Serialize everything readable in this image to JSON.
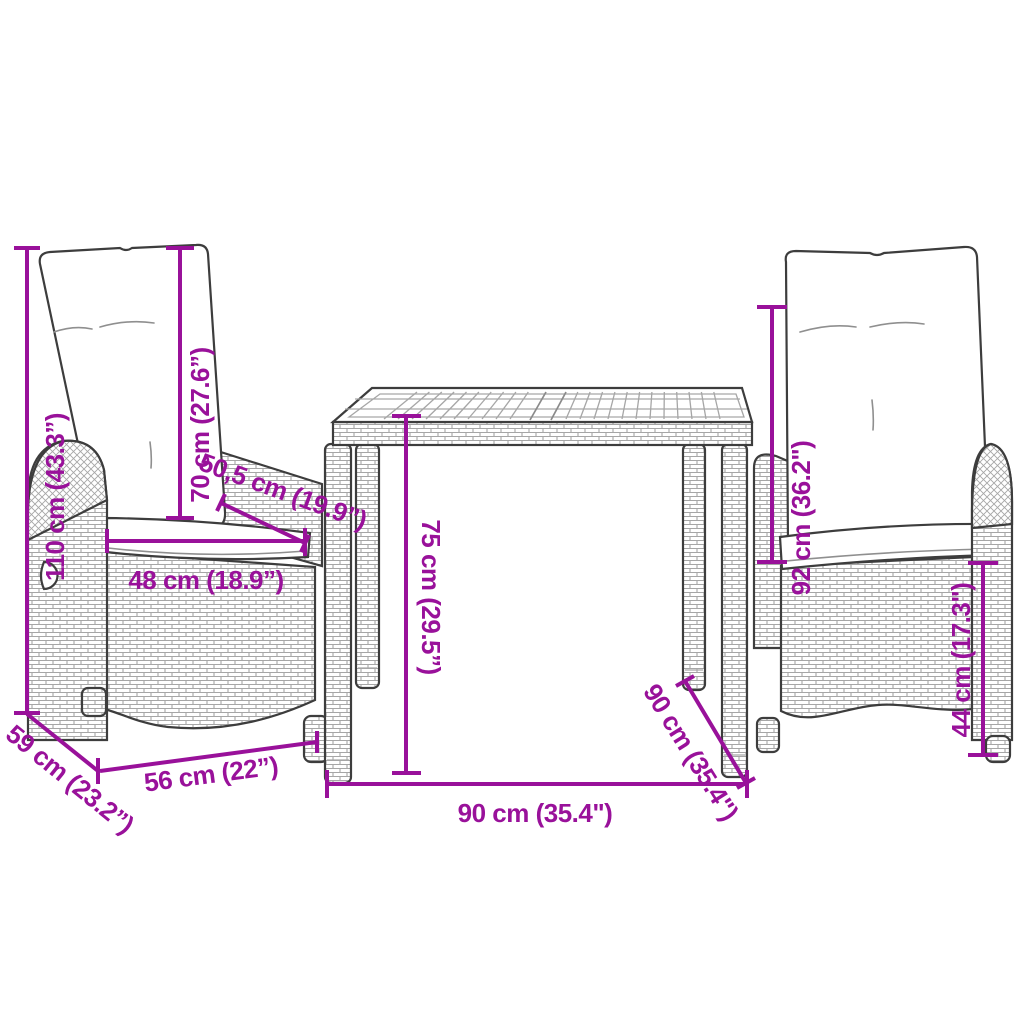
{
  "colors": {
    "accent": "#99119A",
    "outline": "#3D3D3D",
    "weave": "#A6A6A6",
    "background": "#FFFFFF"
  },
  "dimensions": {
    "chair_total_height": "110 cm (43.3”)",
    "chair_back_height": "70 cm (27.6”)",
    "chair_seat_depth": "50,5 cm (19.9”)",
    "chair_seat_width": "48 cm (18.9”)",
    "chair_width": "56 cm (22”)",
    "chair_depth": "59 cm (23.2”)",
    "table_height": "75 cm (29.5”)",
    "table_width": "90 cm (35.4\")",
    "table_depth": "90 cm (35.4\")",
    "right_chair_height": "92 cm (36.2\")",
    "right_chair_seat_height": "44 cm (17.3\")"
  }
}
